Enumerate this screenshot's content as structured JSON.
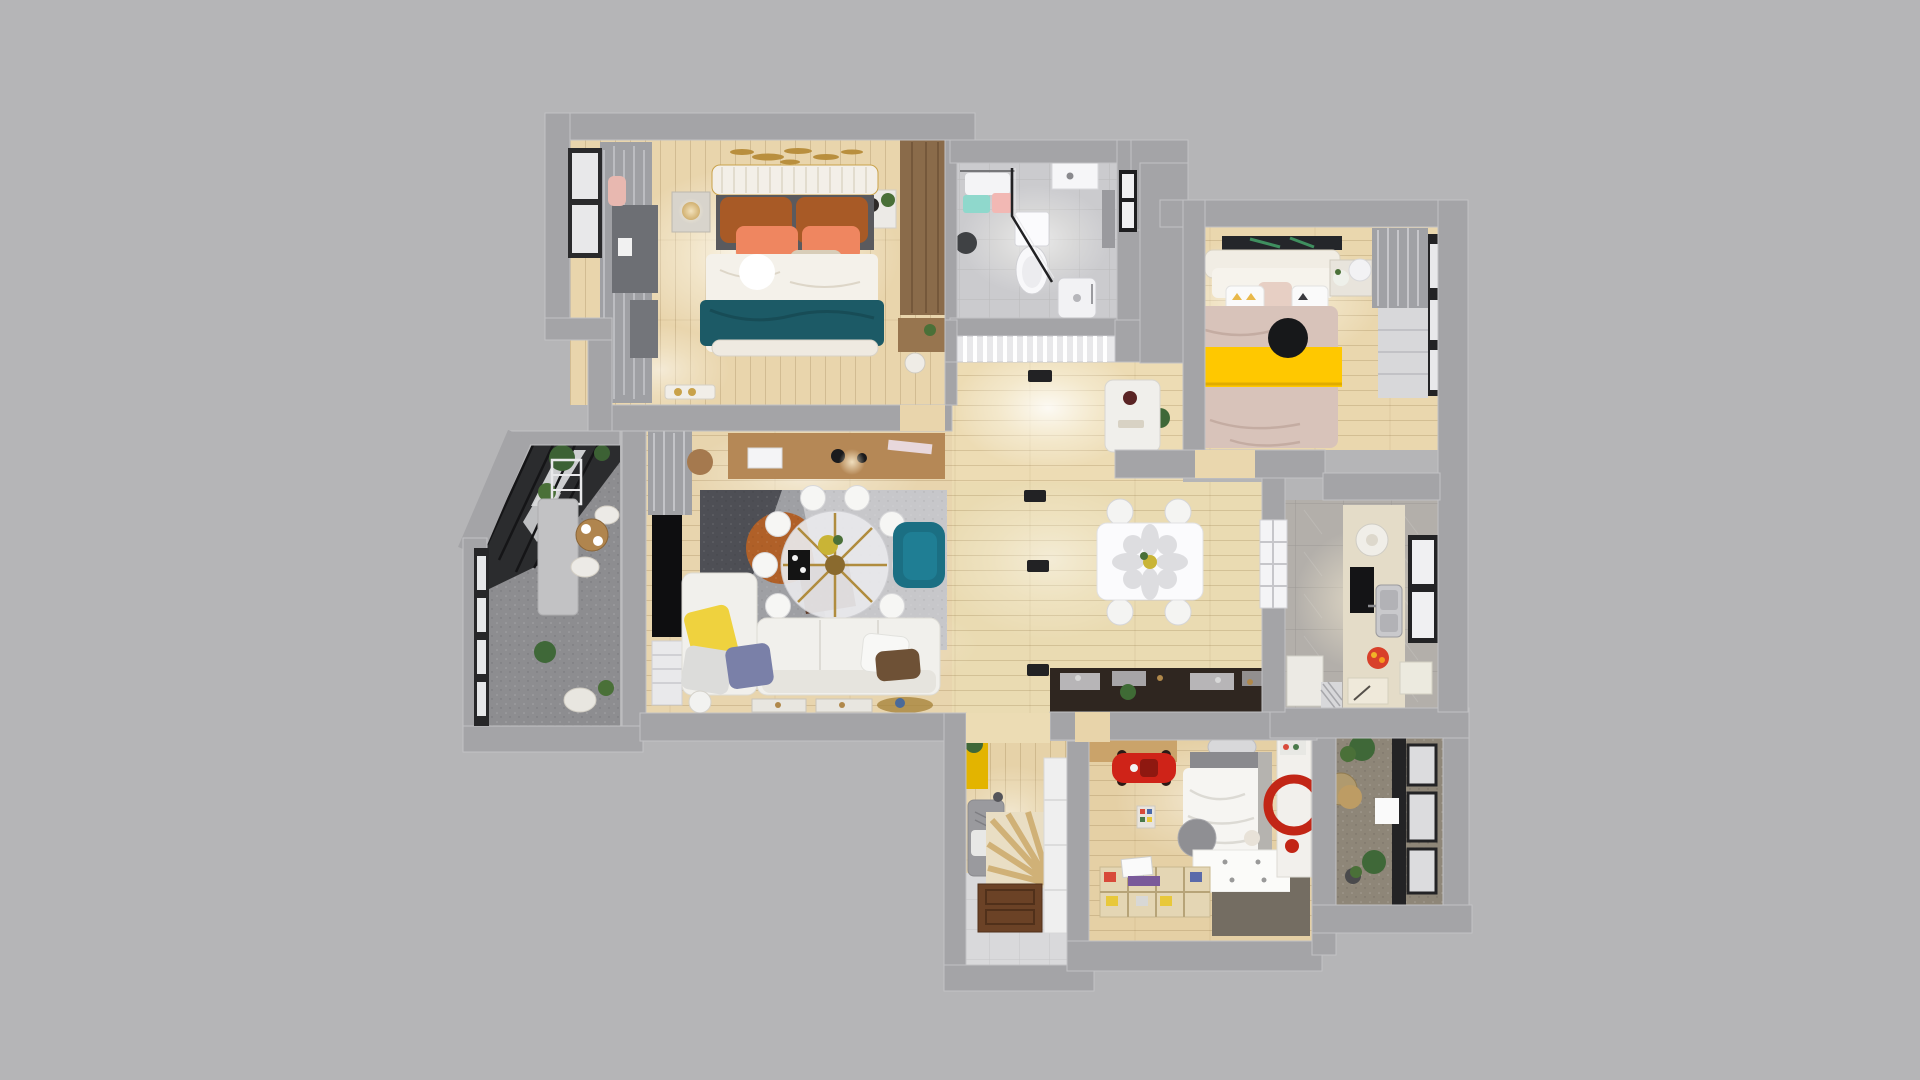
{
  "canvas": {
    "width": 1920,
    "height": 1080,
    "background": "#b5b5b7",
    "wall": "#a4a4a7"
  },
  "palette": {
    "wood": "#e7d3ab",
    "wood_bright": "#f6ecd3",
    "tile": "#cbcbce",
    "marble": "#b3afaa",
    "stone": "#8d8d90",
    "stone_warm": "#8e8678",
    "rug_base": "#9fa0a4",
    "rug_dark": "#4e4f55",
    "rug_orange": "#b06028",
    "rug_brown": "#5e3a28",
    "rug_light": "#c7c7ca",
    "sofa": "#f1f0ec",
    "teal_armchair": "#1b6f83",
    "teal_throw": "#1c5a66",
    "copper_pillow": "#a85a26",
    "salmon_pillow": "#ef8660",
    "yellow_pillow": "#efd23e",
    "yellow_blanket": "#ffc800",
    "yellow_locker": "#e3b400",
    "blue_pillow": "#7a80a8",
    "brown_pillow": "#6e5136",
    "wardrobe_wood": "#8a6b4a",
    "console_wood": "#b58856",
    "desk_wood": "#caa36a",
    "red_car": "#cf2318",
    "red_art": "#c22616",
    "door_brown": "#6b4226",
    "plant": "#3f6838",
    "curtain": "#a0a1a5",
    "black": "#17181a",
    "white": "#f6f6f4",
    "glass_frame": "#232325",
    "counter_dark": "#2f2620",
    "counter_cream": "#e4dcc8",
    "duvet_blush": "#d8c3ba",
    "headboard": "#f3efe8"
  },
  "scene": {
    "type": "3d-floor-plan-render",
    "rooms": [
      {
        "name": "master-bedroom",
        "furniture": [
          "double-bed",
          "teal-throw",
          "copper-pillows",
          "nightstands",
          "wardrobe",
          "curtains",
          "window",
          "ceiling-light"
        ]
      },
      {
        "name": "bathroom",
        "furniture": [
          "toilet",
          "shower-enclosure",
          "shower-tray",
          "vanity",
          "towels",
          "waste-bin",
          "window"
        ]
      },
      {
        "name": "bedroom-2",
        "furniture": [
          "double-bed",
          "yellow-blanket",
          "black-ceiling-light",
          "nightstands",
          "wall-art",
          "roman-blind-window"
        ]
      },
      {
        "name": "kitchen",
        "furniture": [
          "counter",
          "sink",
          "water-heater",
          "built-in-oven",
          "fruit-plate",
          "window",
          "glazed-door"
        ]
      },
      {
        "name": "hallway-dining",
        "furniture": [
          "dining-table",
          "chairs",
          "sideboard",
          "bar-counter",
          "downlights",
          "ac-grille"
        ]
      },
      {
        "name": "living-room",
        "furniture": [
          "l-sofa",
          "pillows",
          "geometric-rug",
          "round-glass-table",
          "white-chairs",
          "teal-armchair",
          "tv",
          "console",
          "curtains"
        ]
      },
      {
        "name": "balcony-west",
        "furniture": [
          "glass-roof",
          "plants",
          "round-table",
          "chairs",
          "storage-cabinet",
          "shelf-rack"
        ]
      },
      {
        "name": "entry",
        "furniture": [
          "yellow-locker",
          "bench",
          "sunburst-rug",
          "shoe-cabinet",
          "wood-door"
        ]
      },
      {
        "name": "kids-bedroom",
        "furniture": [
          "desk",
          "red-toy-car",
          "single-bed",
          "drawer-platform",
          "organizer-shelf",
          "enso-art-panel",
          "round-pouf"
        ]
      },
      {
        "name": "balcony-south-east",
        "furniture": [
          "glazed-wall",
          "plants",
          "rattan-chair",
          "side-table",
          "white-unit"
        ]
      }
    ]
  }
}
